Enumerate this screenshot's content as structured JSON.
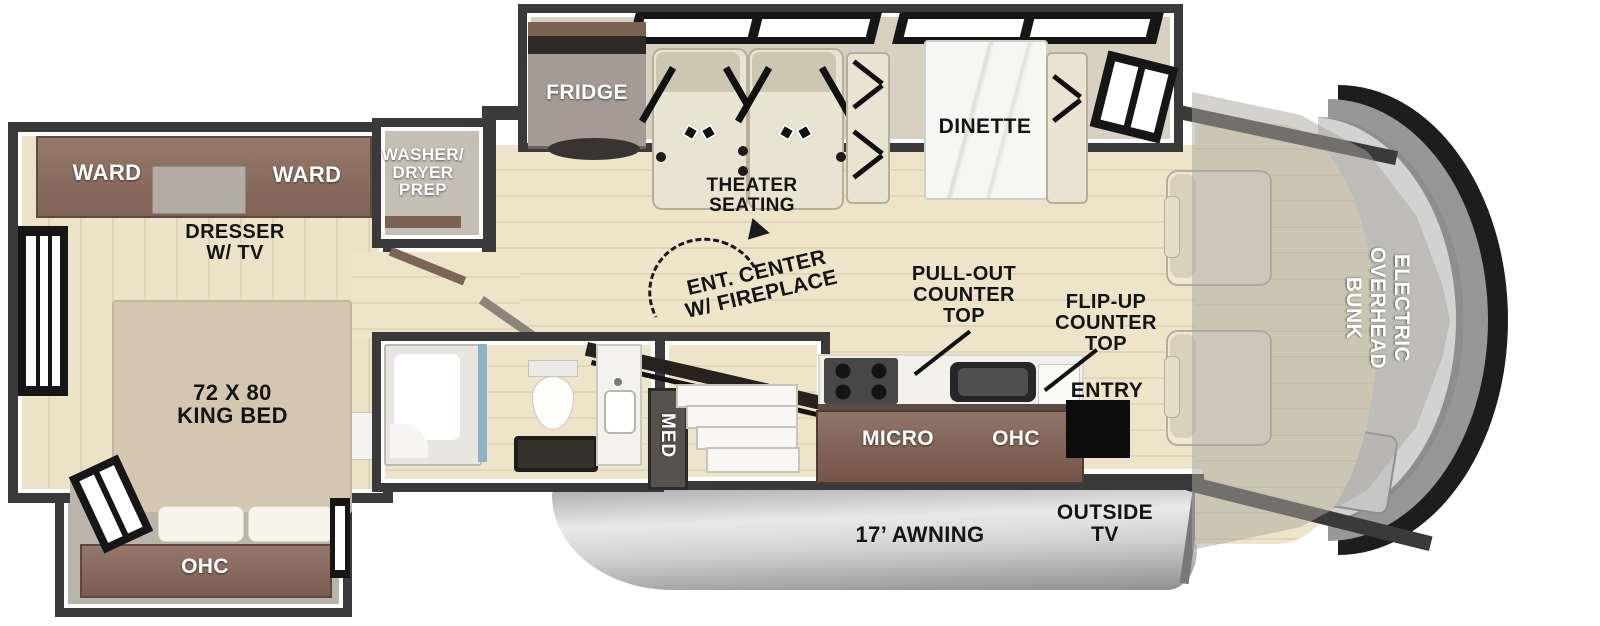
{
  "diagram": {
    "bedroom": {
      "ward_left": "WARD",
      "ward_right": "WARD",
      "dresser_tv": "DRESSER\nW/ TV",
      "king_bed": "72 X 80\nKING BED",
      "ohc": "OHC"
    },
    "utility": {
      "washer_dryer_prep": "WASHER/\nDRYER\nPREP",
      "med_cabinet": "MED"
    },
    "living": {
      "fridge": "FRIDGE",
      "theater_seating": "THEATER\nSEATING",
      "dinette": "DINETTE",
      "ent_center": "ENT. CENTER\nW/ FIREPLACE"
    },
    "kitchen": {
      "pull_out_counter": "PULL-OUT\nCOUNTER\nTOP",
      "flip_up_counter": "FLIP-UP\nCOUNTER\nTOP",
      "micro": "MICRO",
      "ohc": "OHC",
      "entry": "ENTRY"
    },
    "cab": {
      "overhead_bunk": "ELECTRIC\nOVERHEAD\nBUNK"
    },
    "exterior": {
      "awning": "17’ AWNING",
      "outside_tv": "OUTSIDE\nTV"
    }
  },
  "colors": {
    "wall": "#3a3a3a",
    "floor_wood": "#eae0c6",
    "cabinet_brown": "#87695c",
    "seat_beige": "#e9e4d1",
    "awning_silver": "#d6d6d6",
    "shower_glass_teal": "#8ab4c2",
    "label_dark": "#141414",
    "label_light": "#ffffff"
  }
}
